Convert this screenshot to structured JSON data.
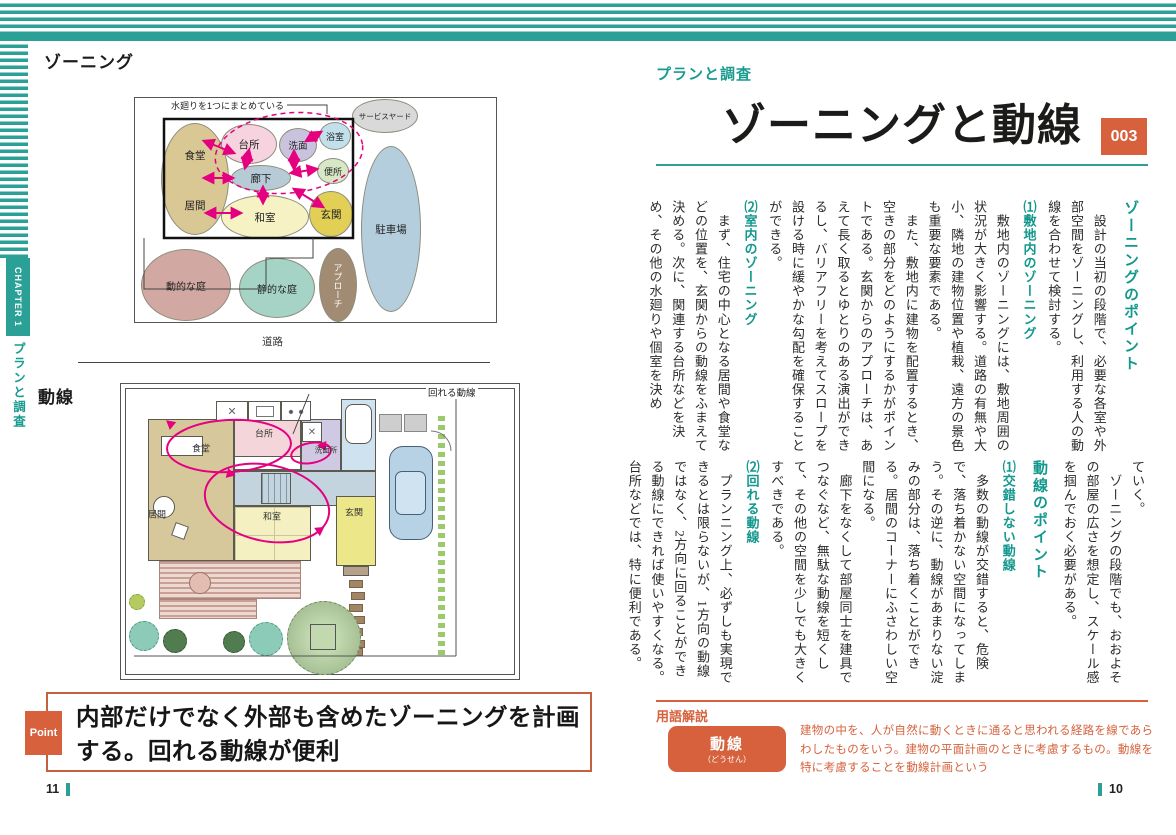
{
  "sidebar": {
    "chapter_label": "CHAPTER 1",
    "chapter_title": "プランと調査"
  },
  "left_page": {
    "fig_zoning": {
      "caption": "ゾーニング",
      "note": "水廻りを1つにまとめている",
      "road_label": "道路",
      "zones": [
        "食堂",
        "居間",
        "台所",
        "洗面",
        "浴室",
        "便所",
        "廊下",
        "和室",
        "玄関",
        "サービスヤード",
        "駐車場",
        "アプローチ",
        "動的な庭",
        "静的な庭"
      ]
    },
    "fig_flow": {
      "caption": "動線",
      "note": "回れる動線",
      "rooms": [
        "食堂",
        "台所",
        "洗面所",
        "居間",
        "和室",
        "玄関"
      ]
    },
    "point": {
      "badge": "Point",
      "text": "内部だけでなく外部も含めたゾーニングを計画する。回れる動線が便利"
    },
    "page_number": "11"
  },
  "right_page": {
    "category": "プランと調査",
    "title": "ゾーニングと動線",
    "number": "003",
    "page_number": "10",
    "article_top": [
      {
        "type": "h1",
        "text": "ゾーニングのポイント"
      },
      {
        "type": "p",
        "text": "　設計の当初の段階で、必要な各室や外部空間をゾーニングし、利用する人の動線を合わせて検討する。"
      },
      {
        "type": "h2",
        "text": "⑴敷地内のゾーニング"
      },
      {
        "type": "p",
        "text": "　敷地内のゾーニングには、敷地周囲の状況が大きく影響する。道路の有無や大小、隣地の建物位置や植栽、遠方の景色も重要な要素である。"
      },
      {
        "type": "p",
        "text": "　また、敷地内に建物を配置するとき、空きの部分をどのようにするかがポイントである。玄関からのアプローチは、あえて長く取るとゆとりのある演出ができるし、バリアフリーを考えてスロープを設ける時に緩やかな勾配を確保することができる。"
      },
      {
        "type": "h2",
        "text": "⑵室内のゾーニング"
      },
      {
        "type": "p",
        "text": "　まず、住宅の中心となる居間や食堂などの位置を、玄関からの動線をふまえて決める。次に、関連する台所などを決め、その他の水廻りや個室を決め"
      }
    ],
    "article_bottom": [
      {
        "type": "p",
        "text": "ていく。"
      },
      {
        "type": "p",
        "text": "　ゾーニングの段階でも、おおよその部屋の広さを想定し、スケール感を掴んでおく必要がある。"
      },
      {
        "type": "h1",
        "text": "動線のポイント"
      },
      {
        "type": "h2",
        "text": "⑴交錯しない動線"
      },
      {
        "type": "p",
        "text": "　多数の動線が交錯すると、危険で、落ち着かない空間になってしまう。その逆に、動線があまりない淀みの部分は、落ち着くことができる。居間のコーナーにふさわしい空間になる。"
      },
      {
        "type": "p",
        "text": "　廊下をなくして部屋同士を建具でつなぐなど、無駄な動線を短くして、その他の空間を少しでも大きくすべきである。"
      },
      {
        "type": "h2",
        "text": "⑵回れる動線"
      },
      {
        "type": "p",
        "text": "　プランニング上、必ずしも実現できるとは限らないが、1方向の動線ではなく、2方向に回ることができる動線にできれば使いやすくなる。台所などでは、特に便利である。"
      }
    ],
    "glossary": {
      "section_label": "用語解説",
      "term": "動線",
      "reading": "（どうせん）",
      "definition": "建物の中を、人が自然に動くときに通ると思われる経路を線であらわしたものをいう。建物の平面計画のときに考慮するもの。動線を特に考慮することを動線計画という"
    }
  },
  "colors": {
    "accent_teal": "#2aa096",
    "accent_orange": "#d6613c",
    "flow_magenta": "#e4007f",
    "zone_dining_living": "#d9c794",
    "zone_kitchen": "#f6d3de",
    "zone_washroom": "#c9c3de",
    "zone_bath": "#c2e0ec",
    "zone_toilet": "#d8e8c6",
    "zone_corridor": "#b7cbd7",
    "zone_tatami": "#f6f2c4",
    "zone_entrance": "#e2cf56",
    "zone_service_yard": "#d9d9d9",
    "zone_parking": "#b4cede",
    "zone_approach": "#a18b72",
    "zone_garden_dynamic": "#d2a8a2",
    "zone_garden_static": "#a5d3c5"
  }
}
